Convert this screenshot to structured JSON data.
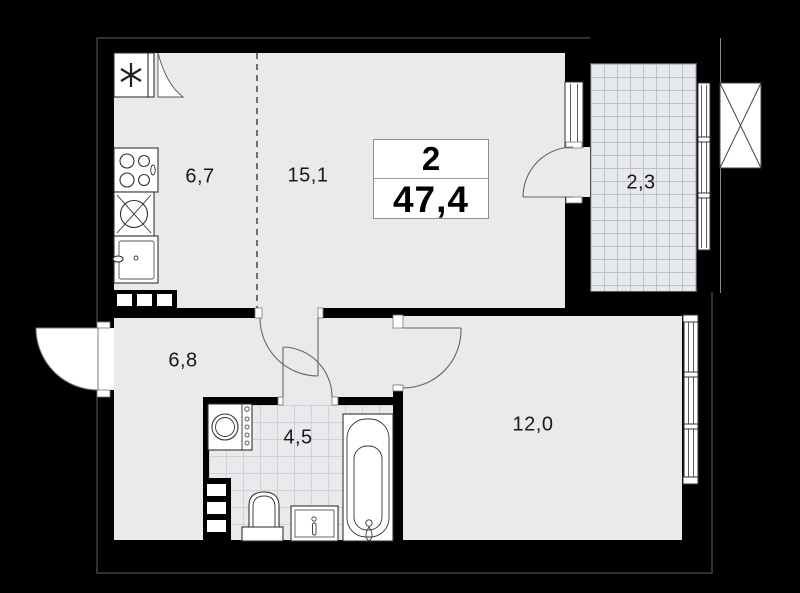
{
  "apartment": {
    "rooms_count": "2",
    "total_area": "47,4",
    "rooms": [
      {
        "id": "kitchen",
        "area": "6,7"
      },
      {
        "id": "living",
        "area": "15,1"
      },
      {
        "id": "balcony",
        "area": "2,3"
      },
      {
        "id": "hallway",
        "area": "6,8"
      },
      {
        "id": "bathroom",
        "area": "4,5"
      },
      {
        "id": "bedroom",
        "area": "12,0"
      }
    ],
    "colors": {
      "background": "#000000",
      "walls": "#000000",
      "floor": "#e8eaec",
      "balcony_grid": "#bcc2c9",
      "tile_grid": "#cdd3d9",
      "fixture_outline": "#333333",
      "door_arc": "#666666",
      "label_text": "#16181a"
    }
  }
}
